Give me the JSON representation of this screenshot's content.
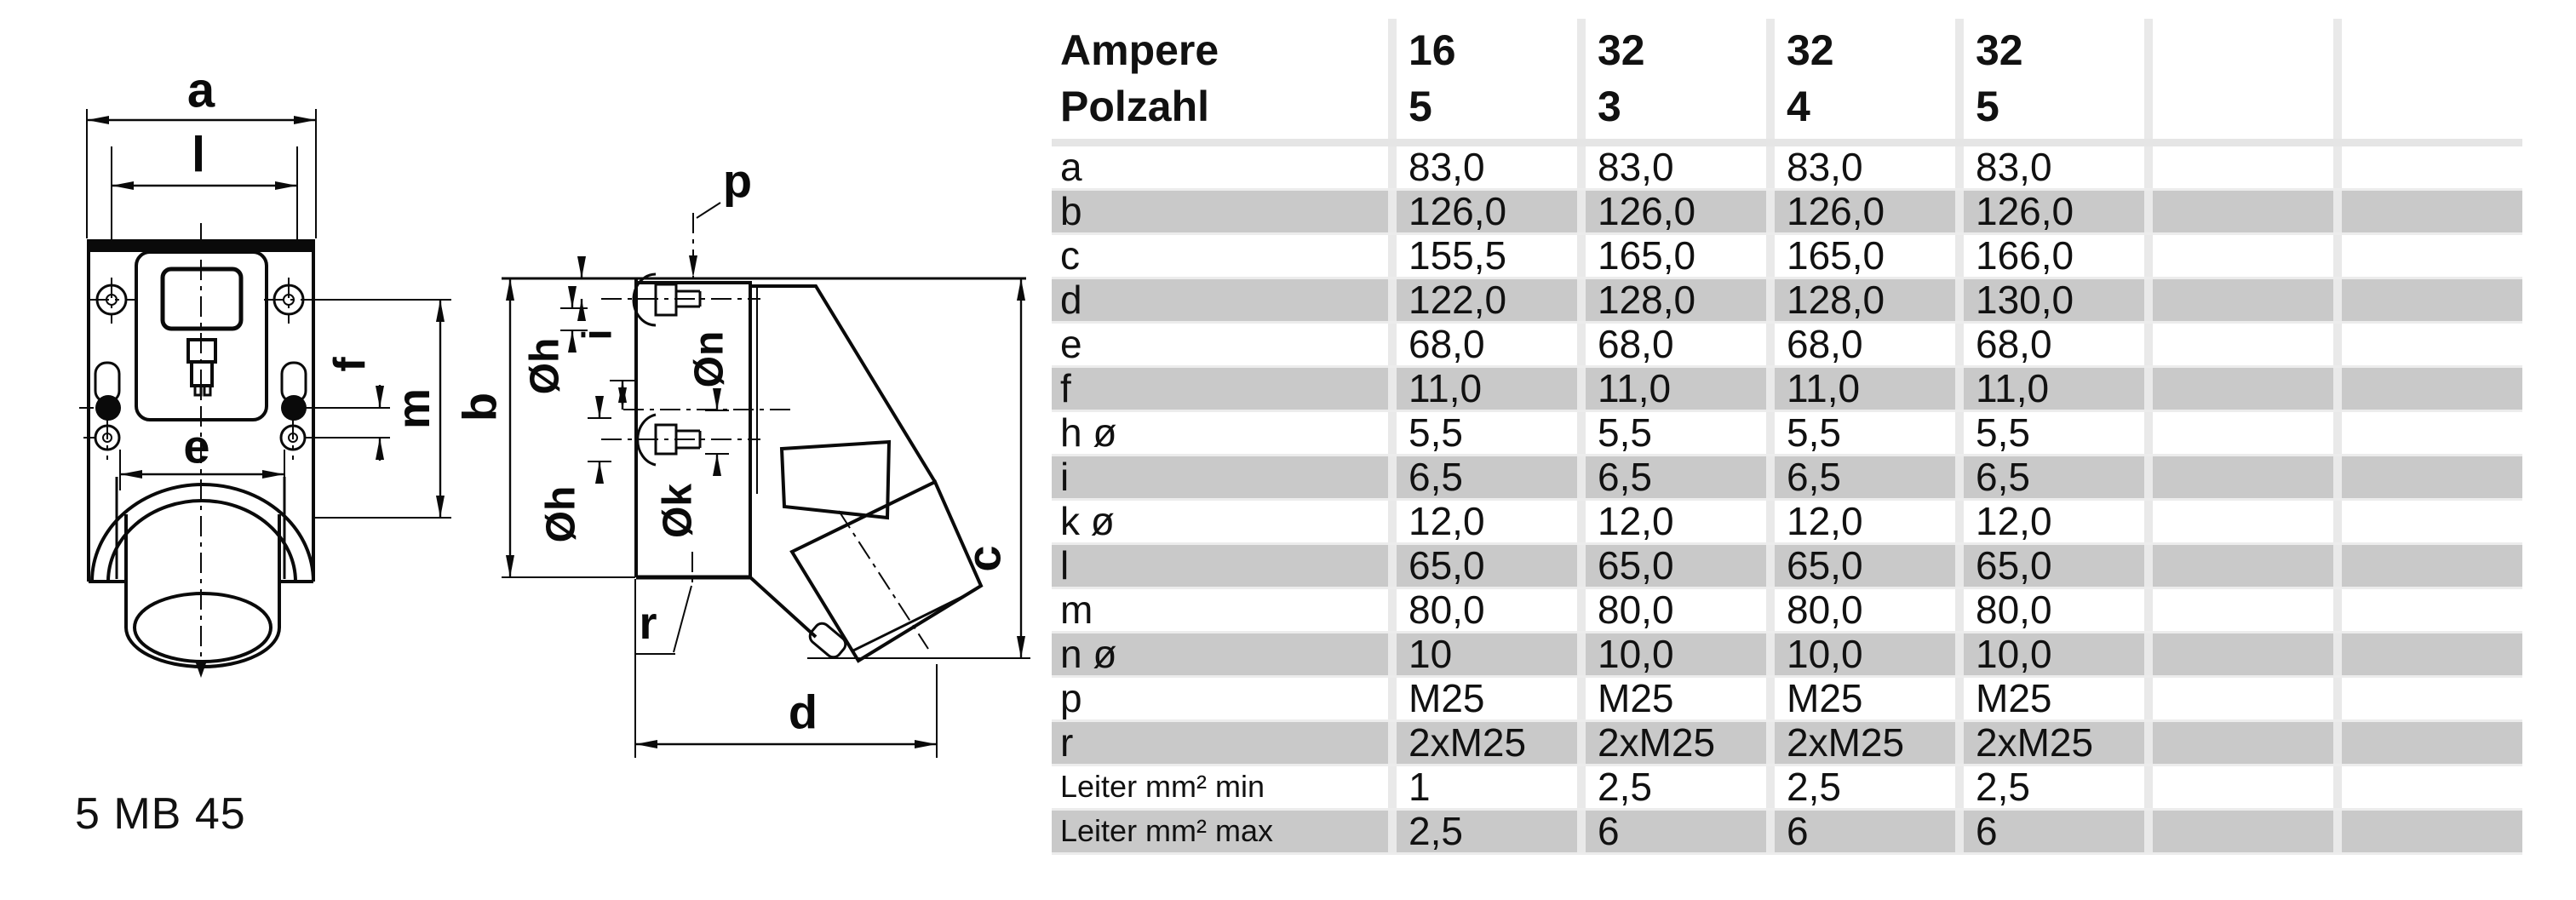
{
  "model_label": "5 MB 45",
  "drawing": {
    "labels": {
      "a": "a",
      "l": "l",
      "e": "e",
      "f": "f",
      "m": "m",
      "p": "p",
      "b": "b",
      "c": "c",
      "d": "d",
      "r": "r",
      "oh_top": "Øh",
      "i": "i",
      "on": "Øn",
      "oh_bottom": "Øh",
      "ok": "Øk"
    }
  },
  "table": {
    "colors": {
      "row_shaded": "#c9c9c9",
      "gap": "#e9e9e9",
      "separator": "#e5e5e5"
    },
    "header": {
      "row1_label": "Ampere",
      "row2_label": "Polzahl",
      "row1_values": [
        "16",
        "32",
        "32",
        "32",
        "",
        ""
      ],
      "row2_values": [
        "5",
        "3",
        "4",
        "5",
        "",
        ""
      ]
    },
    "rows": [
      {
        "label": "a",
        "values": [
          "83,0",
          "83,0",
          "83,0",
          "83,0",
          "",
          ""
        ],
        "shaded": false
      },
      {
        "label": "b",
        "values": [
          "126,0",
          "126,0",
          "126,0",
          "126,0",
          "",
          ""
        ],
        "shaded": true
      },
      {
        "label": "c",
        "values": [
          "155,5",
          "165,0",
          "165,0",
          "166,0",
          "",
          ""
        ],
        "shaded": false
      },
      {
        "label": "d",
        "values": [
          "122,0",
          "128,0",
          "128,0",
          "130,0",
          "",
          ""
        ],
        "shaded": true
      },
      {
        "label": "e",
        "values": [
          "68,0",
          "68,0",
          "68,0",
          "68,0",
          "",
          ""
        ],
        "shaded": false
      },
      {
        "label": "f",
        "values": [
          "11,0",
          "11,0",
          "11,0",
          "11,0",
          "",
          ""
        ],
        "shaded": true
      },
      {
        "label": "h ø",
        "values": [
          "5,5",
          "5,5",
          "5,5",
          "5,5",
          "",
          ""
        ],
        "shaded": false
      },
      {
        "label": "i",
        "values": [
          "6,5",
          "6,5",
          "6,5",
          "6,5",
          "",
          ""
        ],
        "shaded": true
      },
      {
        "label": "k ø",
        "values": [
          "12,0",
          "12,0",
          "12,0",
          "12,0",
          "",
          ""
        ],
        "shaded": false
      },
      {
        "label": "l",
        "values": [
          "65,0",
          "65,0",
          "65,0",
          "65,0",
          "",
          ""
        ],
        "shaded": true
      },
      {
        "label": "m",
        "values": [
          "80,0",
          "80,0",
          "80,0",
          "80,0",
          "",
          ""
        ],
        "shaded": false
      },
      {
        "label": "n ø",
        "values": [
          "10",
          "10,0",
          "10,0",
          "10,0",
          "",
          ""
        ],
        "shaded": true
      },
      {
        "label": "p",
        "values": [
          "M25",
          "M25",
          "M25",
          "M25",
          "",
          ""
        ],
        "shaded": false
      },
      {
        "label": "r",
        "values": [
          "2xM25",
          "2xM25",
          "2xM25",
          "2xM25",
          "",
          ""
        ],
        "shaded": true
      },
      {
        "label": "Leiter mm² min",
        "values": [
          "1",
          "2,5",
          "2,5",
          "2,5",
          "",
          ""
        ],
        "shaded": false,
        "small": true
      },
      {
        "label": "Leiter mm² max",
        "values": [
          "2,5",
          "6",
          "6",
          "6",
          "",
          ""
        ],
        "shaded": true,
        "small": true
      }
    ]
  }
}
